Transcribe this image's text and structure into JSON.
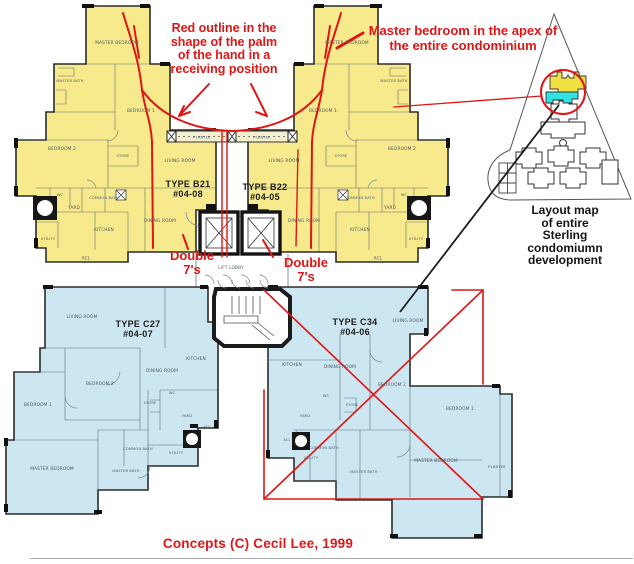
{
  "colors": {
    "plan_yellow": "#F6EA8C",
    "plan_blue": "#CDE7F2",
    "annotation_red": "#E01515",
    "map_highlight_yellow": "#F0E040",
    "map_highlight_cyan": "#2FE3E3",
    "wall_black": "#1C1C1C",
    "room_label_grey": "#4D5A66"
  },
  "annotations": {
    "palm_note": "Red outline in the\nshape of the palm\nof the hand in a\nreceiving position",
    "apex_note": "Master bedroom in the apex of\nthe entire condominium",
    "double_sevens_left": "Double\n7's",
    "double_sevens_right": "Double\n7's",
    "layout_map_caption": "Layout map\nof entire\nSterling\ncondomiumn\ndevelopment",
    "credit": "Concepts (C)  Cecil Lee, 1999"
  },
  "units": [
    {
      "id": "B21",
      "type_label": "TYPE B21",
      "unit_no": "#04-08",
      "rooms": [
        "MASTER BEDROOM",
        "MASTER BATH",
        "BEDROOM 1",
        "BEDROOM 2",
        "STORE",
        "LIVING ROOM",
        "DINING ROOM",
        "WC",
        "COMMON BATH",
        "YARD",
        "KITCHEN",
        "UTILITY",
        "ACL"
      ]
    },
    {
      "id": "B22",
      "type_label": "TYPE B22",
      "unit_no": "#04-05",
      "rooms": [
        "MASTER BEDROOM",
        "MASTER BATH",
        "BEDROOM 1",
        "BEDROOM 2",
        "STORE",
        "LIVING ROOM",
        "DINING ROOM",
        "WC",
        "COMMON BATH",
        "YARD",
        "KITCHEN",
        "UTILITY",
        "ACL"
      ]
    },
    {
      "id": "C27",
      "type_label": "TYPE C27",
      "unit_no": "#04-07",
      "rooms": [
        "LIVING ROOM",
        "BEDROOM 2",
        "BEDROOM 1",
        "MASTER BEDROOM",
        "DINING ROOM",
        "KITCHEN",
        "STORE",
        "WC",
        "YARD",
        "ACL",
        "COMMON BATH",
        "MASTER BATH",
        "UTILITY"
      ]
    },
    {
      "id": "C34",
      "type_label": "TYPE C34",
      "unit_no": "#04-06",
      "rooms": [
        "LIVING ROOM",
        "DINING ROOM",
        "BEDROOM 2",
        "BEDROOM 1",
        "MASTER BEDROOM",
        "KITCHEN",
        "STORE",
        "WC",
        "YARD",
        "ACL",
        "COMMON BATH",
        "MASTER BATH",
        "UTILITY",
        "PLANTER"
      ]
    }
  ],
  "common": {
    "lift_lobby": "LIFT LOBBY",
    "planter": "PLANTER"
  }
}
